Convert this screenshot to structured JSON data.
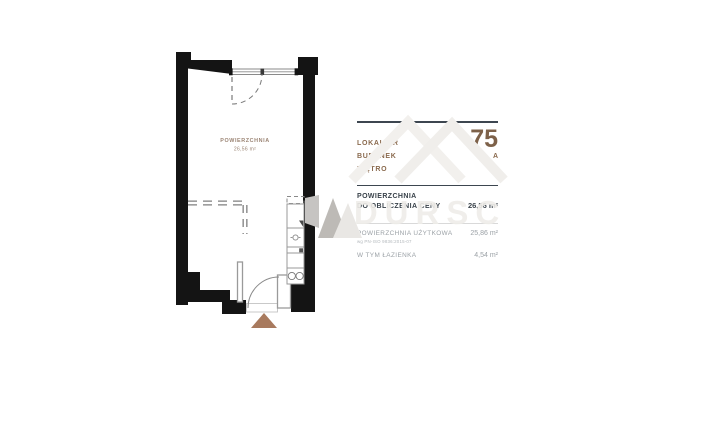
{
  "floorplan": {
    "room_label": "POWIERZCHNIA",
    "room_area": "26,56 m²"
  },
  "panel": {
    "rows": [
      {
        "label": "LOKAL NR",
        "value": "75"
      },
      {
        "label": "BUDYNEK",
        "value": "A"
      },
      {
        "label": "PIĘTRO",
        "value": "3"
      }
    ],
    "price_area_label_line1": "POWIERZCHNIA",
    "price_area_label_line2": "DO OBLICZENIA CENY",
    "price_area_value": "26,56 m²",
    "usable_area_label": "POWIERZCHNIA UŻYTKOWA",
    "usable_area_note": "wg PN-ISO 9836:2015-07",
    "usable_area_value": "25,86 m²",
    "bathroom_label": "W TYM ŁAZIENKA",
    "bathroom_value": "4,54 m²"
  },
  "watermark": {
    "text": "DURSC"
  },
  "colors": {
    "accent_brown": "#85644a",
    "dark_text": "#39424a",
    "gray_text": "#9ba1a6",
    "wall": "#141414",
    "entrance_triangle": "#a87a5e",
    "room_label": "#9b8474"
  }
}
